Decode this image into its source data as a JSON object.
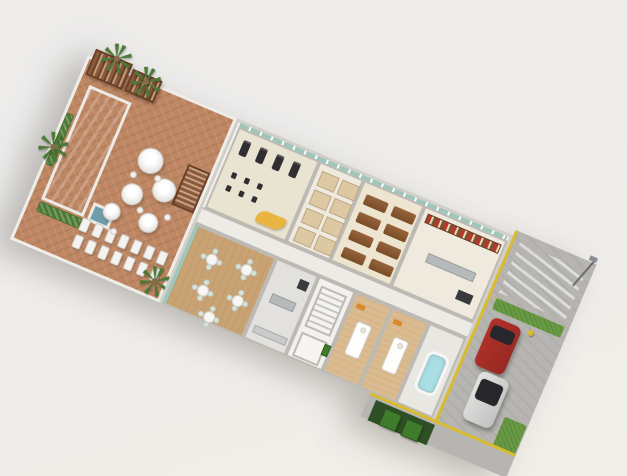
{
  "scene": {
    "description": "3D isometric rendering of a spa and wellness amenity floor plan with outdoor pool deck, indoor gym, restaurant, shop, treatment rooms and a parking strip",
    "visible_text": "",
    "rotation_deg": 23
  },
  "palette": {
    "bg_top": "#EDECEB",
    "bg_bottom": "#F1EEE8",
    "slab": "#F3F1ED",
    "wall": "#BDBAB4",
    "wall_light": "#E6E3DE",
    "deck": "#BE8662",
    "coping": "#ECEAE4",
    "pool_top": "#97BDC8",
    "pool_bot": "#79A4B1",
    "spa": "#6F9DAB",
    "glass": "#9EC6BB",
    "glass_dark": "#26262B",
    "pergola": "#8A5A3C",
    "pergola_dark": "#6B4229",
    "palm": "#4C7A36",
    "trunk": "#8A6A4A",
    "gym_floor": "#E9E3D2",
    "equip": "#2E2E33",
    "desk": "#E9B440",
    "locker_floor": "#EFEADF",
    "stall": "#DCC8A2",
    "relax_floor": "#EDE5D0",
    "bench": "#96633A",
    "bench_dark": "#7A4D28",
    "shop_floor": "#F0EADE",
    "shelf": "#7C5233",
    "goods": "#B23A2B",
    "corridor": "#EDEBE6",
    "rest_floor": "#C9A273",
    "chair": "#D7E4DC",
    "kitchen": "#E2E1DD",
    "steel": "#B6BABB",
    "dark": "#3A3A3C",
    "stairs_a": "#F4F3F1",
    "stairs_b": "#C7C5C1",
    "treat_floor": "#D8B78B",
    "towel": "#D98A2B",
    "tub": "#ABDEE4",
    "asphalt": "#B7B5B2",
    "yellow": "#D9BB2F",
    "lawn": "#679A43",
    "pad": "#2F5026",
    "bin": "#3F7C2B"
  },
  "deck": {
    "palms": [
      {
        "x": 10,
        "y": -26
      },
      {
        "x": 46,
        "y": -16
      },
      {
        "x": -14,
        "y": 80
      },
      {
        "x": 132,
        "y": 164
      }
    ],
    "umbrellas": [
      {
        "x": 96,
        "y": 70,
        "r": 13
      },
      {
        "x": 120,
        "y": 92,
        "r": 12
      },
      {
        "x": 92,
        "y": 108,
        "r": 11
      },
      {
        "x": 118,
        "y": 128,
        "r": 10
      },
      {
        "x": 80,
        "y": 132,
        "r": 9
      }
    ],
    "chairs": [
      {
        "x": 82,
        "y": 86
      },
      {
        "x": 106,
        "y": 80
      },
      {
        "x": 102,
        "y": 116
      },
      {
        "x": 86,
        "y": 146
      },
      {
        "x": 130,
        "y": 112
      }
    ],
    "loungers": {
      "rows": 2,
      "cols": 7,
      "step_x": 14,
      "step_y": 18
    }
  },
  "gym": {
    "treadmills": [
      {
        "x": 8,
        "y": 8
      },
      {
        "x": 26,
        "y": 8
      },
      {
        "x": 44,
        "y": 8
      },
      {
        "x": 62,
        "y": 8
      }
    ],
    "bikes": [
      {
        "x": 10,
        "y": 42
      },
      {
        "x": 24,
        "y": 42
      },
      {
        "x": 38,
        "y": 42
      },
      {
        "x": 10,
        "y": 56
      },
      {
        "x": 24,
        "y": 56
      },
      {
        "x": 38,
        "y": 56
      }
    ]
  },
  "lockers": {
    "rows": 4,
    "cols": 2,
    "x": 4,
    "y": 6,
    "step_x": 22,
    "step_y": 20
  },
  "relax": {
    "rows": 4,
    "cols": 2,
    "x": 6,
    "y": 10,
    "step_x": 30,
    "step_y": 19
  },
  "restaurant": {
    "tables": [
      {
        "x": 14,
        "y": 14
      },
      {
        "x": 50,
        "y": 10
      },
      {
        "x": 18,
        "y": 46
      },
      {
        "x": 54,
        "y": 42
      },
      {
        "x": 34,
        "y": 68
      }
    ],
    "chair_offsets": [
      {
        "x": 8,
        "y": -1
      },
      {
        "x": 8,
        "y": 16
      },
      {
        "x": -1,
        "y": 8
      },
      {
        "x": 16,
        "y": 8
      }
    ]
  },
  "treatment": {
    "rooms": [
      {
        "x": 174
      },
      {
        "x": 214
      }
    ]
  },
  "parking": {
    "cars": [
      {
        "name": "red-car",
        "x": 10,
        "y": 88,
        "w": 32,
        "h": 52,
        "color": "#B23129",
        "glass_h": 14
      },
      {
        "name": "white-car",
        "x": 20,
        "y": 142,
        "w": 32,
        "h": 52,
        "color": "#E4E4E3",
        "glass_h": 22
      }
    ],
    "lawns": [
      {
        "x": 6,
        "y": 70,
        "w": 74,
        "h": 12
      },
      {
        "x": 60,
        "y": 176,
        "w": 24,
        "h": 44
      }
    ],
    "dumpsters": [
      {
        "x": 12,
        "y": 4
      },
      {
        "x": 36,
        "y": 5
      }
    ]
  }
}
